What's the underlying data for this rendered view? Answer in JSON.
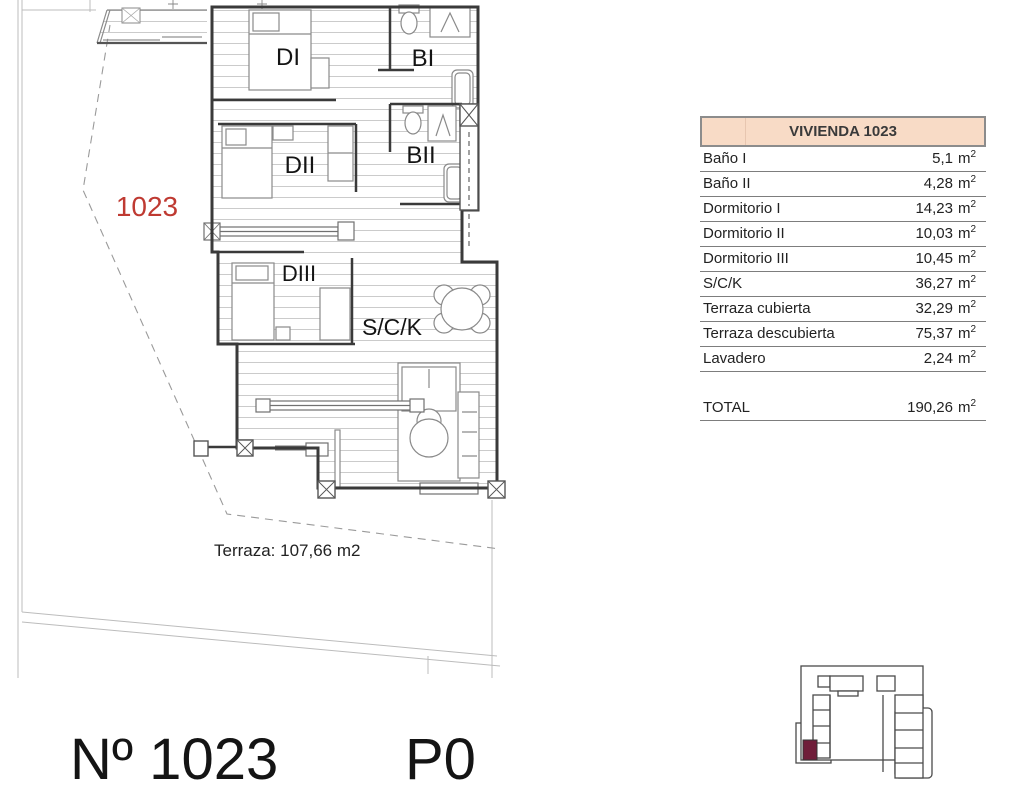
{
  "plan": {
    "rooms": {
      "di": "DI",
      "bi": "BI",
      "dii": "DII",
      "bii": "BII",
      "diii": "DIII",
      "sck": "S/C/K"
    },
    "unit_number_red": "1023",
    "unit_number_color": "#bf3a32",
    "terrace_note": "Terraza: 107,66 m2"
  },
  "table": {
    "title": "VIVIENDA 1023",
    "header_bg": "#f8dbc6",
    "unit_base": "m",
    "unit_sup": "2",
    "rows": [
      {
        "label": "Baño I",
        "value": "5,1"
      },
      {
        "label": "Baño II",
        "value": "4,28"
      },
      {
        "label": "Dormitorio I",
        "value": "14,23"
      },
      {
        "label": "Dormitorio II",
        "value": "10,03"
      },
      {
        "label": "Dormitorio III",
        "value": "10,45"
      },
      {
        "label": "S/C/K",
        "value": "36,27"
      },
      {
        "label": "Terraza cubierta",
        "value": "32,29"
      },
      {
        "label": "Terraza descubierta",
        "value": "75,37"
      },
      {
        "label": "Lavadero",
        "value": "2,24"
      }
    ],
    "total": {
      "label": "TOTAL",
      "value": "190,26"
    }
  },
  "footer": {
    "unit_label": "Nº 1023",
    "floor_label": "P0"
  },
  "keyplan": {
    "highlight_color": "#6f1d39"
  }
}
